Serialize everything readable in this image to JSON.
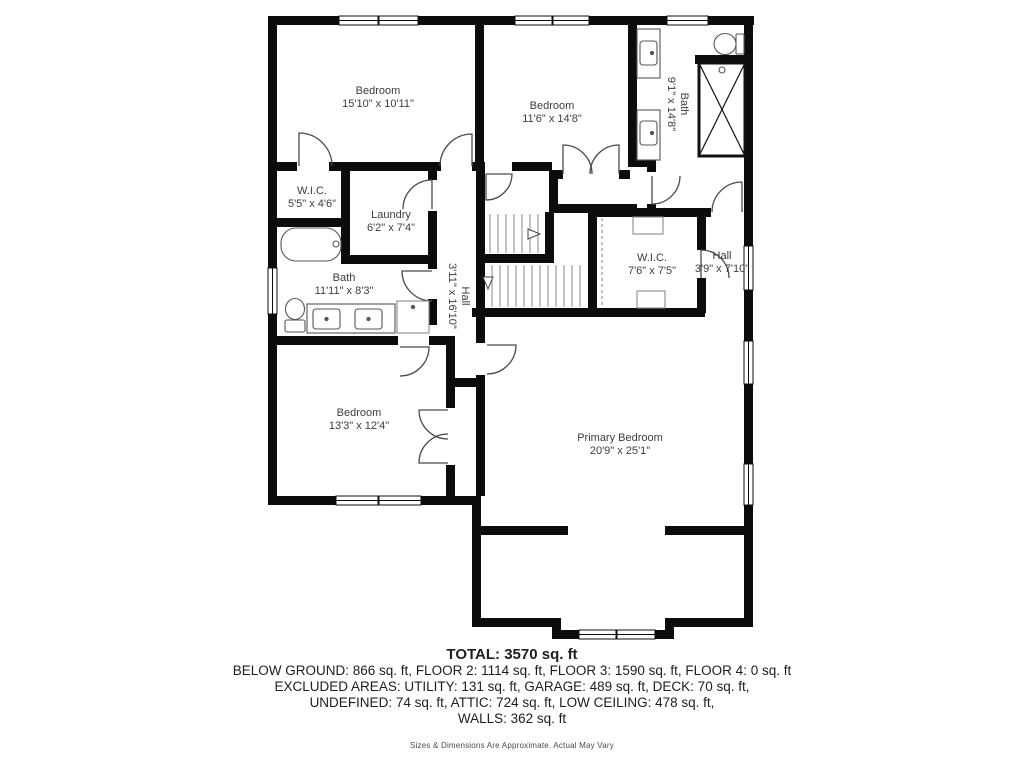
{
  "floor_plan": {
    "rooms": [
      {
        "name": "Bedroom",
        "dims": "15'10\" x 10'11\""
      },
      {
        "name": "Bedroom",
        "dims": "11'6\" x 14'8\""
      },
      {
        "name": "Bath",
        "dims": "9'1\" x 14'8\""
      },
      {
        "name": "W.I.C.",
        "dims": "5'5\" x 4'6\""
      },
      {
        "name": "Laundry",
        "dims": "6'2\" x 7'4\""
      },
      {
        "name": "Hall",
        "dims": "3'11\" x 16'10\""
      },
      {
        "name": "W.I.C.",
        "dims": "7'6\" x 7'5\""
      },
      {
        "name": "Hall",
        "dims": "3'9\" x 7'10\""
      },
      {
        "name": "Bath",
        "dims": "11'11\" x 8'3\""
      },
      {
        "name": "Bedroom",
        "dims": "13'3\" x 12'4\""
      },
      {
        "name": "Primary Bedroom",
        "dims": "20'9\" x 25'1\""
      }
    ]
  },
  "summary": {
    "total": "TOTAL: 3570 sq. ft",
    "floors_line": "BELOW GROUND: 866 sq. ft, FLOOR 2: 1114 sq. ft, FLOOR 3: 1590 sq. ft, FLOOR 4: 0 sq. ft",
    "excluded_line": "EXCLUDED AREAS: UTILITY: 131 sq. ft, GARAGE: 489 sq. ft, DECK: 70 sq. ft,",
    "undefined_line": "UNDEFINED: 74 sq. ft, ATTIC: 724 sq. ft, LOW CEILING: 478 sq. ft,",
    "walls_line": "WALLS: 362 sq. ft",
    "disclaimer": "Sizes & Dimensions Are Approximate. Actual May Vary"
  },
  "colors": {
    "wall": "#0c0c0c",
    "label_text": "#3d3d3d",
    "fixture_line": "#555555",
    "tread_line": "#8a8a8a",
    "background": "#ffffff"
  }
}
